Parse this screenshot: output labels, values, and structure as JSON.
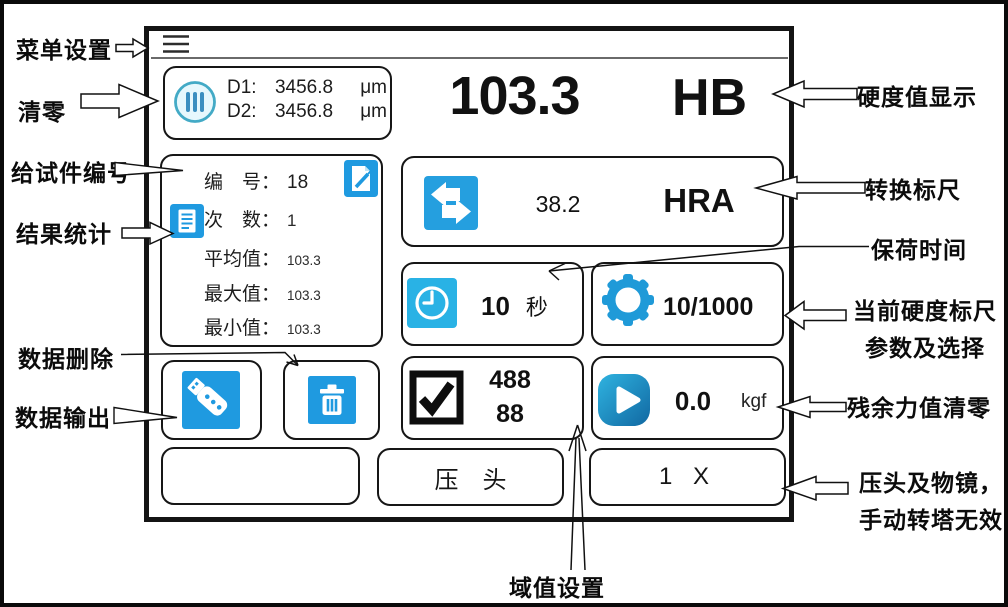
{
  "colors": {
    "accent_blue": "#1f9ae0",
    "clock_blue": "#29b2e5",
    "gear_blue": "#1f9ad8",
    "zero_circle_teal": "#43aac6",
    "frame_black": "#141414"
  },
  "annotations": {
    "menu": "菜单设置",
    "zero": "清零",
    "numbering": "给试件编号",
    "stats": "结果统计",
    "delete": "数据删除",
    "output": "数据输出",
    "display": "硬度值显示",
    "conversion": "转换标尺",
    "dwell": "保荷时间",
    "scale_line1": "当前硬度标尺",
    "scale_line2": "参数及选择",
    "force": "残余力值清零",
    "indenter_line1": "压头及物镜，",
    "indenter_line2": "手动转塔无效",
    "threshold": "域值设置"
  },
  "screen": {
    "readout": {
      "d1_label": "D1:",
      "d1_value": "3456.8",
      "d1_unit": "μm",
      "d2_label": "D2:",
      "d2_value": "3456.8",
      "d2_unit": "μm"
    },
    "hardness": {
      "value": "103.3",
      "scale": "HB"
    },
    "stats": {
      "no_label": "编　号：",
      "no_value": "18",
      "count_label": "次　数：",
      "count_value": "1",
      "avg_label": "平均值：",
      "avg_value": "103.3",
      "max_label": "最大值：",
      "max_value": "103.3",
      "min_label": "最小值：",
      "min_value": "103.3"
    },
    "conversion": {
      "value": "38.2",
      "scale": "HRA"
    },
    "dwell": {
      "value": "10",
      "unit": "秒"
    },
    "scale_param": {
      "value": "10/1000"
    },
    "threshold": {
      "upper": "488",
      "lower": "88"
    },
    "force": {
      "value": "0.0",
      "unit": "kgf"
    },
    "buttons": {
      "indenter": "压　头",
      "objective": "1 X",
      "blank": ""
    }
  }
}
